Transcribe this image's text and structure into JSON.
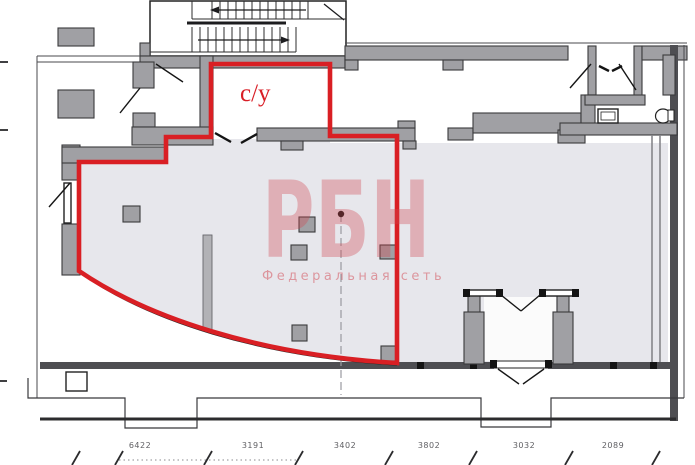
{
  "floor_plan": {
    "room_label": "с/у",
    "watermark": {
      "title": "РБН",
      "subtitle": "Федеральная сеть"
    },
    "dimensions": [
      "6422",
      "3191",
      "3402",
      "3802",
      "3032",
      "2089"
    ],
    "colors": {
      "outline": "#d91f24",
      "label": "#d81e26",
      "watermark": "#d24650",
      "wall": "#a0a0a4",
      "shade": "#e7e7ec"
    }
  }
}
